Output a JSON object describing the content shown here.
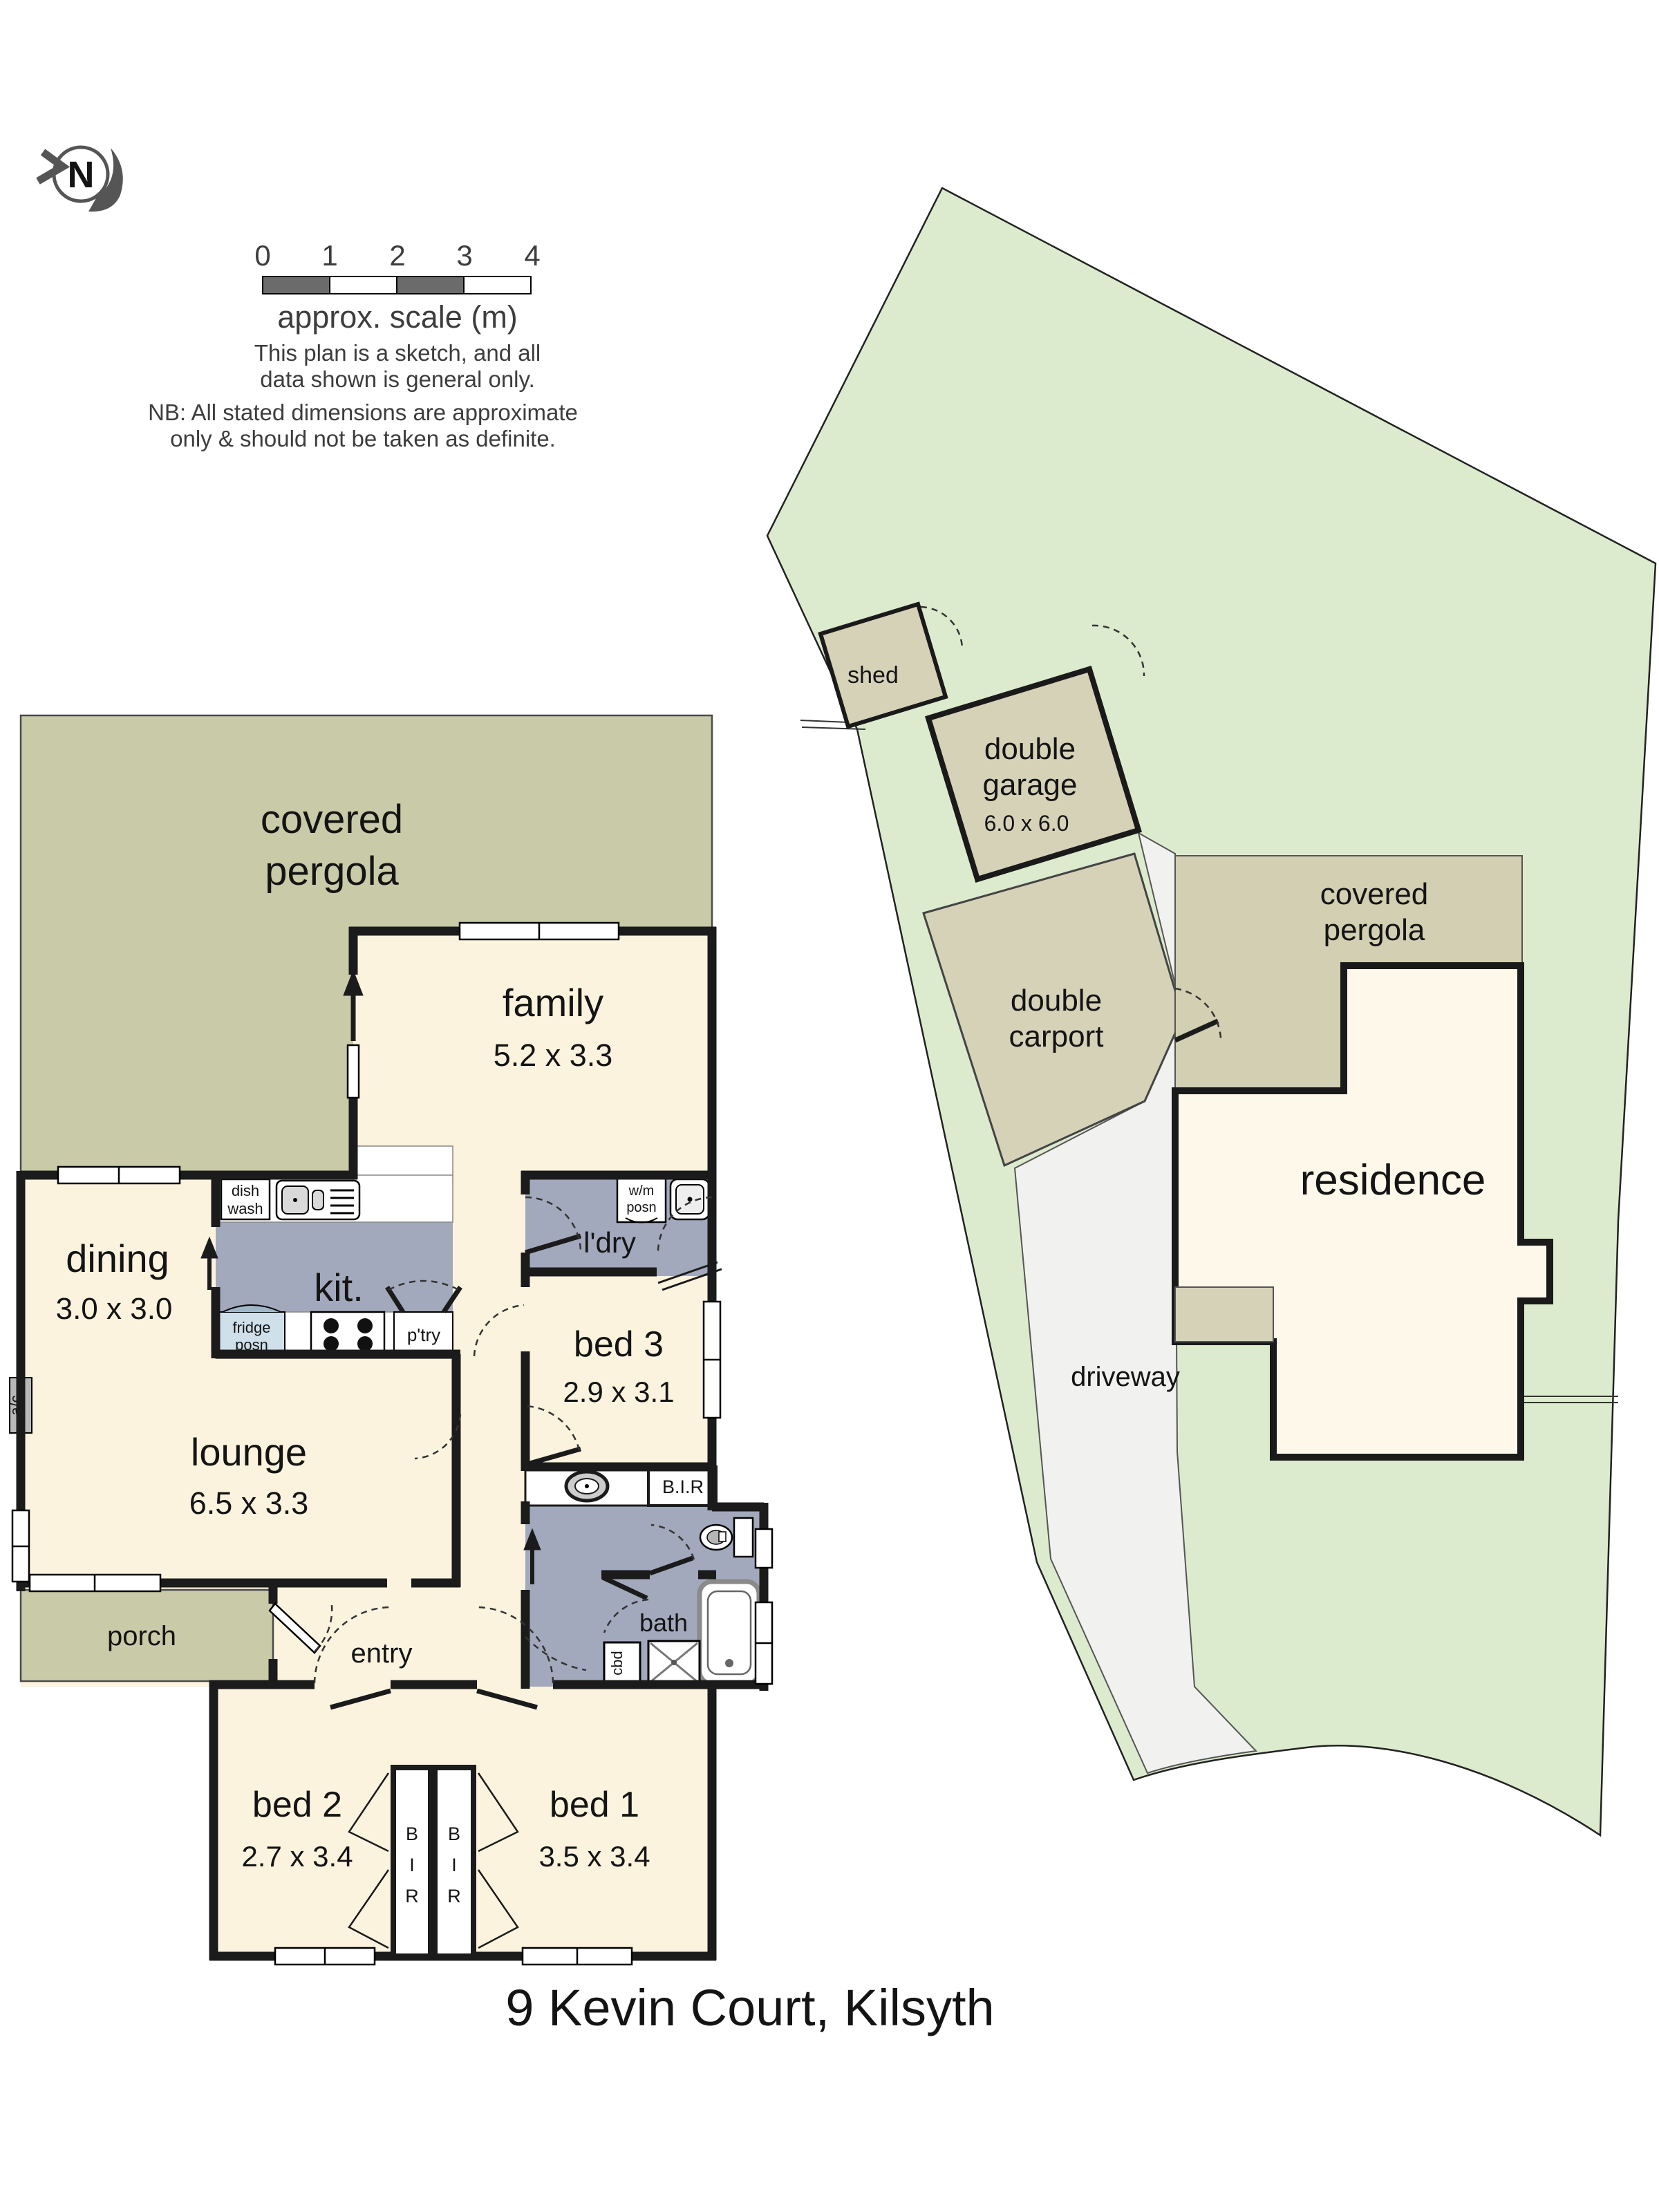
{
  "header": {
    "north_letter": "N",
    "scale_ticks": [
      "0",
      "1",
      "2",
      "3",
      "4"
    ],
    "scale_caption": "approx. scale (m)",
    "sketch_note_line1": "This plan is a sketch, and all",
    "sketch_note_line2": "data shown is general only.",
    "nb_line1": "NB: All stated dimensions are approximate",
    "nb_line2": "only & should not be taken as definite."
  },
  "floor_plan": {
    "pergola_line1": "covered",
    "pergola_line2": "pergola",
    "family": "family",
    "family_dims": "5.2 x 3.3",
    "dining": "dining",
    "dining_dims": "3.0 x 3.0",
    "kitchen": "kit.",
    "laundry": "l'dry",
    "bed3": "bed 3",
    "bed3_dims": "2.9 x 3.1",
    "lounge": "lounge",
    "lounge_dims": "6.5 x 3.3",
    "porch": "porch",
    "entry": "entry",
    "bath": "bath",
    "bed2": "bed 2",
    "bed2_dims": "2.7 x 3.4",
    "bed1": "bed 1",
    "bed1_dims": "3.5 x 3.4",
    "bir": "B.I.R",
    "bir_letters": [
      "B",
      "I",
      "R"
    ],
    "dish_line1": "dish",
    "dish_line2": "wash",
    "wm_line1": "w/m",
    "wm_line2": "posn",
    "fridge_line1": "fridge",
    "fridge_line2": "posn",
    "pantry": "p'try",
    "cbd": "cbd",
    "ac": "a/c"
  },
  "site_plan": {
    "shed": "shed",
    "garage_line1": "double",
    "garage_line2": "garage",
    "garage_dims": "6.0 x 6.0",
    "carport_line1": "double",
    "carport_line2": "carport",
    "pergola_line1": "covered",
    "pergola_line2": "pergola",
    "residence": "residence",
    "driveway": "driveway"
  },
  "title": "9 Kevin Court, Kilsyth",
  "colors": {
    "floor_cream": "#FBF3DE",
    "pergola_olive": "#C9CBA8",
    "wet_gray": "#A3A9BC",
    "lot_green": "#DCEBCE",
    "building_tan": "#D6D2B8",
    "site_pergola_tan": "#D2CFB2",
    "driveway_gray": "#F1F1EF",
    "residence_cream": "#FDF8EA",
    "fridge_blue": "#CFE0EA",
    "wall_dark": "#1B1B1B"
  }
}
